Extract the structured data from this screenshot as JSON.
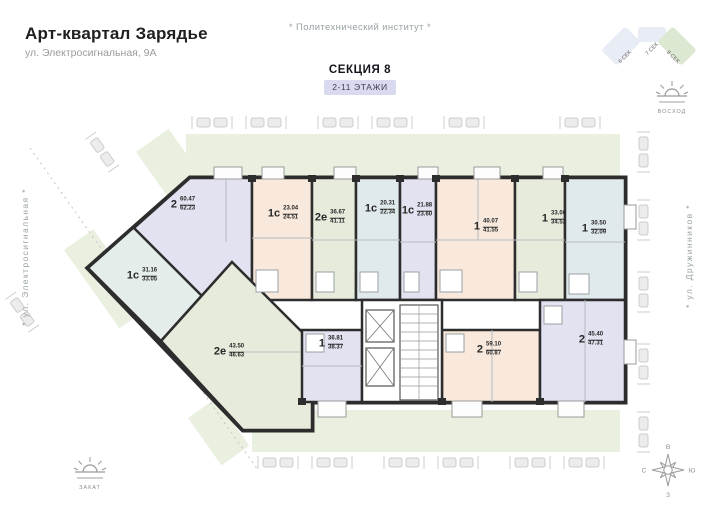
{
  "header": {
    "title": "Арт-квартал Зарядье",
    "subtitle": "ул. Электросигнальная, 9А"
  },
  "landmarks": {
    "top": "* Политехнический институт *",
    "left_street": "* ул. Электросигнальная *",
    "right_street": "* ул. Дружинников *"
  },
  "section_info": {
    "name": "СЕКЦИЯ 8",
    "floors": "2-11 ЭТАЖИ"
  },
  "minimap": {
    "sections": [
      {
        "label": "6 СЕК",
        "highlighted": false
      },
      {
        "label": "7 СЕК",
        "highlighted": false
      },
      {
        "label": "8 СЕК",
        "highlighted": true
      }
    ]
  },
  "orientation": {
    "sunrise_label": "ВОСХОД",
    "sunset_label": "ЗАКАТ",
    "compass": {
      "top": "В",
      "right": "Ю",
      "bottom": "З",
      "left": "С"
    }
  },
  "apartments": [
    {
      "type": "1с",
      "living_area": "31.16",
      "total_area": "33.05",
      "color": "#e4edea"
    },
    {
      "type": "2",
      "living_area": "60.47",
      "total_area": "62.23",
      "color": "#e2e2f1"
    },
    {
      "type": "1с",
      "living_area": "23.04",
      "total_area": "24.51",
      "color": "#f8e9dc"
    },
    {
      "type": "2е",
      "living_area": "36.67",
      "total_area": "41.11",
      "color": "#e6ebdc"
    },
    {
      "type": "1с",
      "living_area": "20.31",
      "total_area": "22.34",
      "color": "#e0eaec"
    },
    {
      "type": "1с",
      "living_area": "21.88",
      "total_area": "23.60",
      "color": "#e2e2f1"
    },
    {
      "type": "1",
      "living_area": "40.07",
      "total_area": "41.55",
      "color": "#f8e9dc"
    },
    {
      "type": "1",
      "living_area": "33.00",
      "total_area": "34.52",
      "color": "#e6ebdc"
    },
    {
      "type": "1",
      "living_area": "30.50",
      "total_area": "32.09",
      "color": "#e0eaec"
    },
    {
      "type": "2е",
      "living_area": "43.50",
      "total_area": "46.63",
      "color": "#e6ebdc"
    },
    {
      "type": "1",
      "living_area": "36.81",
      "total_area": "38.37",
      "color": "#e2e2f1"
    },
    {
      "type": "2",
      "living_area": "59.10",
      "total_area": "60.87",
      "color": "#f8e9dc"
    },
    {
      "type": "2",
      "living_area": "45.40",
      "total_area": "47.31",
      "color": "#e2e2f1"
    }
  ],
  "colors": {
    "wall": "#2d2d2d",
    "greenery": "#eaf0e0",
    "badge_bg": "#d9d9ef",
    "peach": "#f8e9dc",
    "lavender": "#e2e2f1",
    "green": "#e6ebdc",
    "blue": "#e0eaec",
    "mint": "#e4edea",
    "minimap_section": "#e8ecf5",
    "minimap_active": "#dce8d2"
  }
}
